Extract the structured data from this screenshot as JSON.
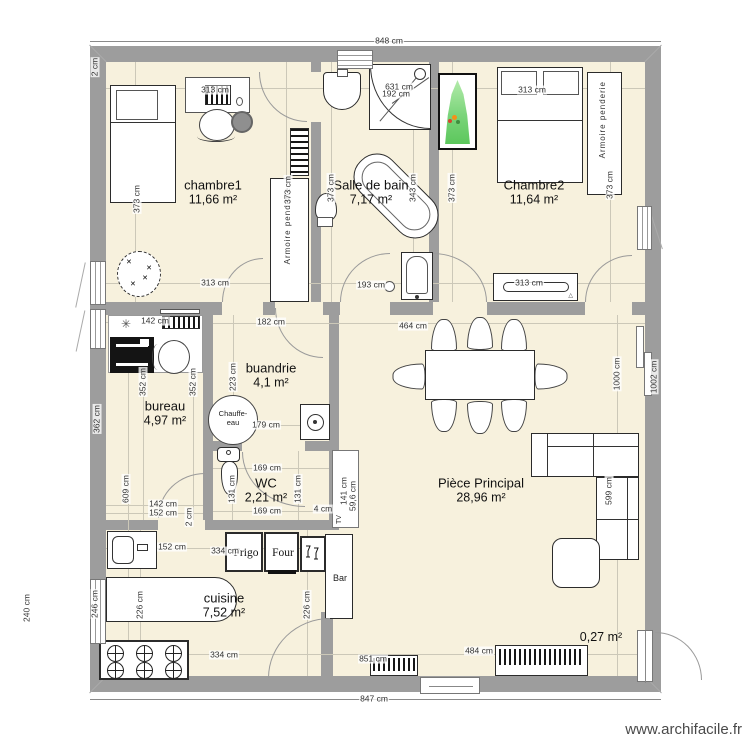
{
  "site_label": "www.archifacile.fr",
  "colors": {
    "wall": "#9d9d9d",
    "floor": "#f7f1dd",
    "plant_green": "#7ad47a"
  },
  "rooms": {
    "chambre1": {
      "name": "chambre1",
      "area": "11,66 m²"
    },
    "salle_de_bain": {
      "name": "Salle de bain",
      "area": "7,17 m²"
    },
    "chambre2": {
      "name": "Chambre2",
      "area": "11,64 m²"
    },
    "bureau": {
      "name": "bureau",
      "area": "4,97 m²"
    },
    "buandrie": {
      "name": "buandrie",
      "area": "4,1 m²"
    },
    "wc": {
      "name": "WC",
      "area": "2,21 m²"
    },
    "piece_principale": {
      "name": "Pièce Principal",
      "area": "28,96 m²"
    },
    "cuisine": {
      "name": "cuisine",
      "area": "7,52 m²"
    },
    "entry_nook": {
      "area": "0,27 m²"
    }
  },
  "furniture": {
    "frigo": "Frigo",
    "four": "Four",
    "bar": "Bar",
    "tv": "TV",
    "chauffe_line1": "Chauffe-",
    "chauffe_line2": "eau",
    "armoire": "Armoire  penderie"
  },
  "dims": {
    "ext_top": "848 cm",
    "ext_bottom": "847 cm",
    "ext_left": "362 cm",
    "ext_right": "1002 cm",
    "top_left_wall": "2 cm",
    "c1_top": "313 cm",
    "c1_bottom": "313 cm",
    "c1_bed": "373 cm",
    "c1_right": "373 cm",
    "sdb_left": "373 cm",
    "sdb_631": "631 cm",
    "sdb_192": "192 cm",
    "sdb_tub": "343 cm",
    "sdb_bottom": "193 cm",
    "c2_top": "313 cm",
    "c2_bottom": "313 cm",
    "c2_left": "373 cm",
    "c2_right": "373 cm",
    "bureau_top": "142 cm",
    "bureau_352_l": "352 cm",
    "bureau_352_r": "352 cm",
    "bureau_609": "609 cm",
    "bureau_142": "142 cm",
    "bureau_152": "152 cm",
    "bureau_2": "2 cm",
    "buand_top": "182 cm",
    "buand_left": "223 cm",
    "buand_mid": "179 cm",
    "wc_top": "169 cm",
    "wc_bottom": "169 cm",
    "wc_left": "131 cm",
    "wc_right": "131 cm",
    "wc_4": "4 cm",
    "tv_141": "141 cm",
    "tv_59": "59,6 cm",
    "pp_table": "464 cm",
    "pp_1000": "1000 cm",
    "pp_599": "599 cm",
    "pp_851": "851 cm",
    "pp_484": "484 cm",
    "cui_sink": "152 cm",
    "cui_334_top": "334 cm",
    "cui_334_bottom": "334 cm",
    "cui_226_l": "226 cm",
    "cui_226_r": "226 cm",
    "cui_win": "246 cm",
    "cui_win_ext": "240 cm"
  }
}
